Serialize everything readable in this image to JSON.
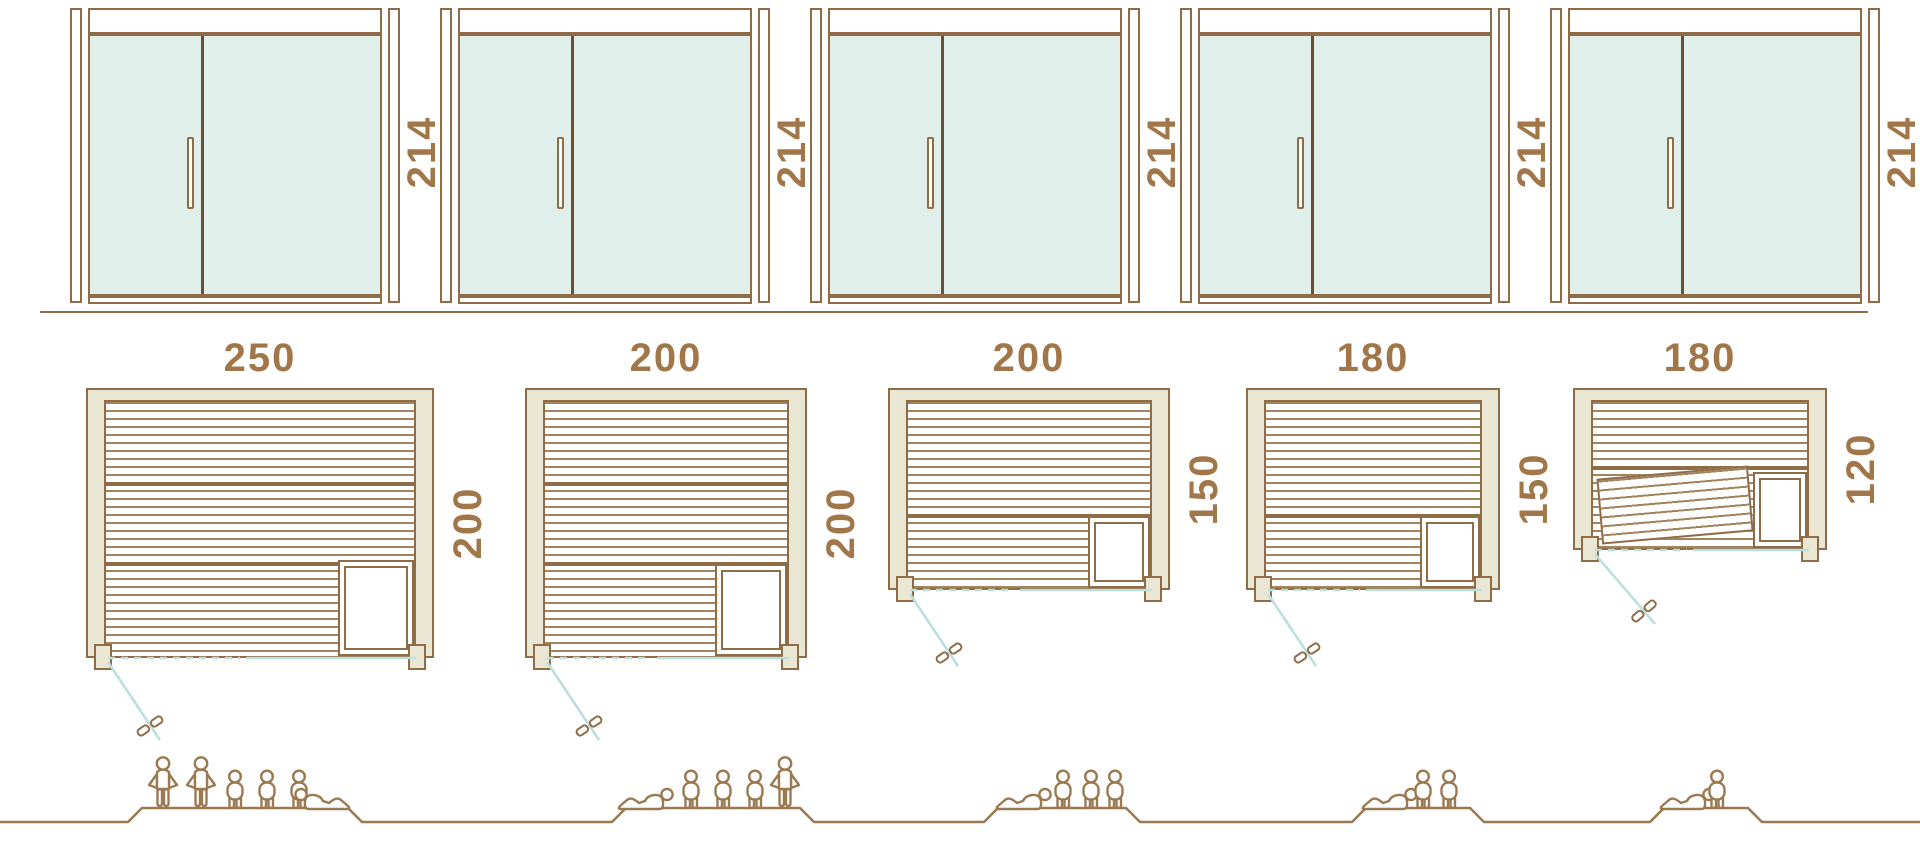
{
  "diagram_title": "Sauna size comparison diagram",
  "units": "cm",
  "colors": {
    "line": "#8f6b46",
    "wood": "#a1835c",
    "beige": "#eae6d4",
    "glass": "#e1efeb",
    "teal": "#bcdedd",
    "text": "#a1774a",
    "fig": "#9b7a52",
    "dark": "#6b4f33"
  },
  "saunas": [
    {
      "door_height_cm": "214",
      "width_cm": "250",
      "depth_cm": "200",
      "capacity": 6,
      "people": {
        "standing": 2,
        "sitting": 3,
        "lying": 1
      }
    },
    {
      "door_height_cm": "214",
      "width_cm": "200",
      "depth_cm": "200",
      "capacity": 5,
      "people": {
        "standing": 1,
        "sitting": 3,
        "lying": 1
      }
    },
    {
      "door_height_cm": "214",
      "width_cm": "200",
      "depth_cm": "150",
      "capacity": 4,
      "people": {
        "standing": 0,
        "sitting": 3,
        "lying": 1
      }
    },
    {
      "door_height_cm": "214",
      "width_cm": "180",
      "depth_cm": "150",
      "capacity": 3,
      "people": {
        "standing": 0,
        "sitting": 2,
        "lying": 1
      }
    },
    {
      "door_height_cm": "214",
      "width_cm": "180",
      "depth_cm": "120",
      "capacity": 2,
      "people": {
        "standing": 0,
        "sitting": 1,
        "lying": 1
      }
    }
  ]
}
